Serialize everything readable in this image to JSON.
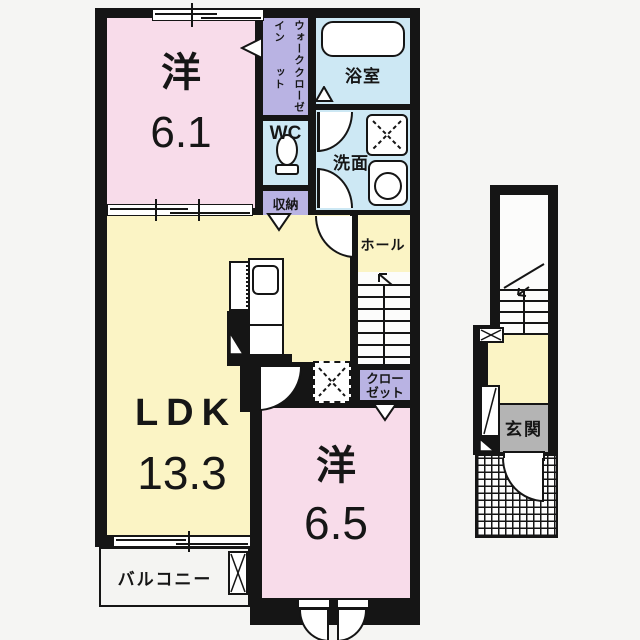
{
  "floor2": {
    "bedroom1": {
      "label": "洋",
      "size": "6.1"
    },
    "walk_in_closet": {
      "column_right": "ウォークイン",
      "column_left": "クローゼット"
    },
    "bathroom": {
      "label": "浴室"
    },
    "toilet": {
      "label": "WC"
    },
    "washroom": {
      "label": "洗面"
    },
    "storage": {
      "label": "収納"
    },
    "hall": {
      "label": "ホール"
    },
    "closet": {
      "line1": "クロー",
      "line2": "ゼット"
    },
    "ldk": {
      "label": "LDK",
      "size": "13.3"
    },
    "bedroom2": {
      "label": "洋",
      "size": "6.5"
    },
    "balcony": {
      "label": "バルコニー"
    }
  },
  "floor1": {
    "entrance": {
      "label": "玄関"
    }
  },
  "colors": {
    "wall": "#151515",
    "room_pink": "#f8dcea",
    "room_yellow": "#fbf4c5",
    "room_blue": "#cde8f4",
    "room_lavender": "#b9b3e3",
    "entrance_gray": "#b4b4b4",
    "background": "#f5f5f3",
    "floor_white": "#fcfcfb"
  }
}
